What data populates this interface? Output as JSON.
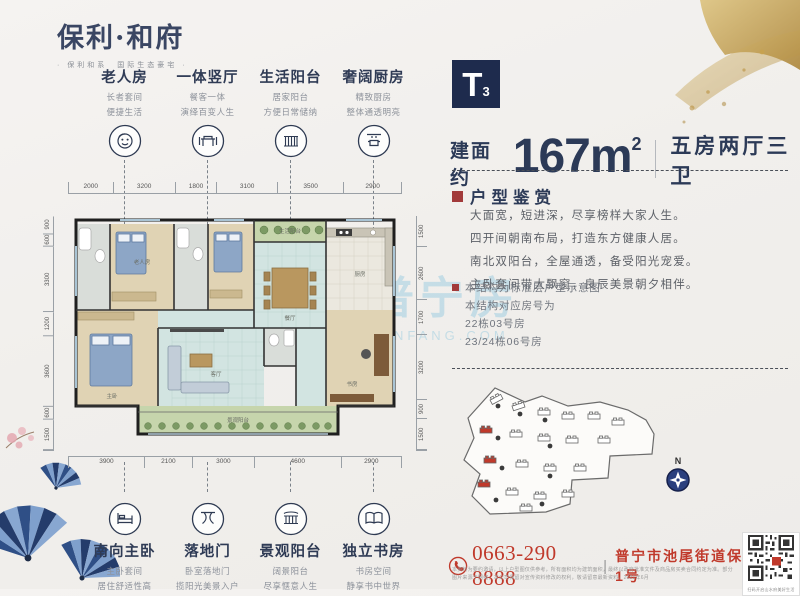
{
  "logo": {
    "title": "保利·和府",
    "subtitle": "· 保利和系　国际生态豪宅 ·"
  },
  "unit": {
    "badge": "T",
    "badge_sub": "3",
    "area_label": "建面约",
    "area_value": "167m",
    "area_sup": "2",
    "rooms": "五房两厅三卫"
  },
  "features_top": [
    {
      "title": "老人房",
      "line1": "长者套间",
      "line2": "便捷生活"
    },
    {
      "title": "一体竖厅",
      "line1": "餐客一体",
      "line2": "演绎百变人生"
    },
    {
      "title": "生活阳台",
      "line1": "居家阳台",
      "line2": "方便日常储纳"
    },
    {
      "title": "奢阔厨房",
      "line1": "精致厨房",
      "line2": "整体通透明亮"
    }
  ],
  "features_bottom": [
    {
      "title": "南向主卧",
      "line1": "主卧套间",
      "line2": "居住舒适性高"
    },
    {
      "title": "落地门",
      "line1": "卧室落地门",
      "line2": "揽阳光美景入户"
    },
    {
      "title": "景观阳台",
      "line1": "阔景阳台",
      "line2": "尽享惬意人生"
    },
    {
      "title": "独立书房",
      "line1": "书房空间",
      "line2": "静享书中世界"
    }
  ],
  "dims": {
    "top": [
      "2000",
      "3200",
      "1800",
      "3100",
      "3500",
      "2900"
    ],
    "bottom": [
      "3900",
      "2100",
      "3000",
      "4600",
      "2900"
    ],
    "left": [
      "900",
      "600",
      "3300",
      "1200",
      "3600",
      "600",
      "1500"
    ],
    "right": [
      "1500",
      "2600",
      "1700",
      "3200",
      "900",
      "1500"
    ]
  },
  "plan": {
    "rooms": [
      "老人房",
      "生活阳台",
      "餐厅",
      "厨房",
      "客厅",
      "主卧",
      "书房",
      "景观阳台"
    ]
  },
  "appreciation": {
    "title": "户型鉴赏",
    "lines": [
      "大面宽，短进深，尽享榜样大家人生。",
      "四开间朝南布局，打造东方健康人居。",
      "南北双阳台，全屋通透，备受阳光宠爱。",
      "主卧套间带大飘窗，良辰美景朝夕相伴。"
    ]
  },
  "notes": {
    "note1": "本结构为标准层户型示意图",
    "note2": "本结构对应房号为",
    "note3": "22栋03号房",
    "note4": "23/24栋06号房"
  },
  "contact": {
    "phone": "0663-290 8888",
    "separator": "|",
    "address": "普宁市池尾街道保利大道1号"
  },
  "fine_print": "本资料为要约邀请，以上户型图仅供参考，所有面积均为建筑面积，最终以政府批准文件及商品房买卖合同约定为准。部分图片来源于网络，本公司保留对宣传资料修改的权利，敬请留意最新资料。2021年6月",
  "qr_caption": "扫码开启山水府美好生活",
  "compass": {
    "label": "N"
  },
  "watermark": {
    "cn": "普宁房",
    "en": "PNFANG.COM"
  },
  "colors": {
    "navy": "#1e2b4d",
    "red": "#c0392b",
    "gold": "#c9a24b",
    "wood": "#e0d3b4",
    "tile": "#d2e4e1",
    "balcony": "#c6d5ac"
  }
}
